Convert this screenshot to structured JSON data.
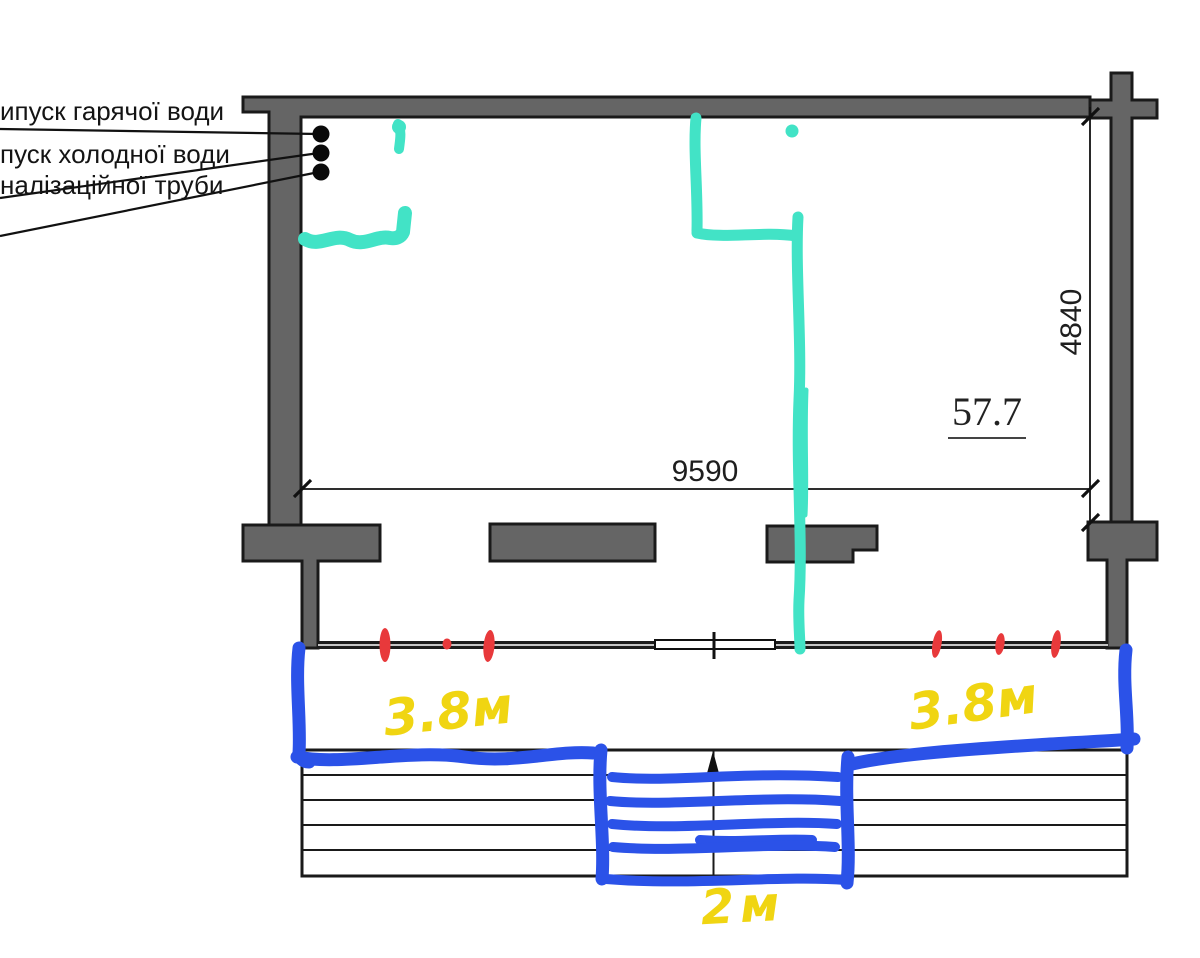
{
  "plan": {
    "pipe_labels": [
      {
        "text": "ипуск гарячої води"
      },
      {
        "text": "пуск холодної води"
      },
      {
        "text": "налізаційної труби"
      }
    ],
    "dimensions": {
      "room_width": "9590",
      "room_depth": "4840",
      "area": "57.7"
    },
    "handwritten": {
      "terrace_left_width": "3.8м",
      "terrace_right_width": "3.8м",
      "stairs_width": "2м"
    },
    "colors": {
      "wall_fill": "#656565",
      "line": "#1a1a1a",
      "cyan_marker": "#42E3C6",
      "blue_marker": "#2B52E8",
      "red_marker": "#E8393B",
      "yellow_marker": "#F0D512"
    }
  }
}
